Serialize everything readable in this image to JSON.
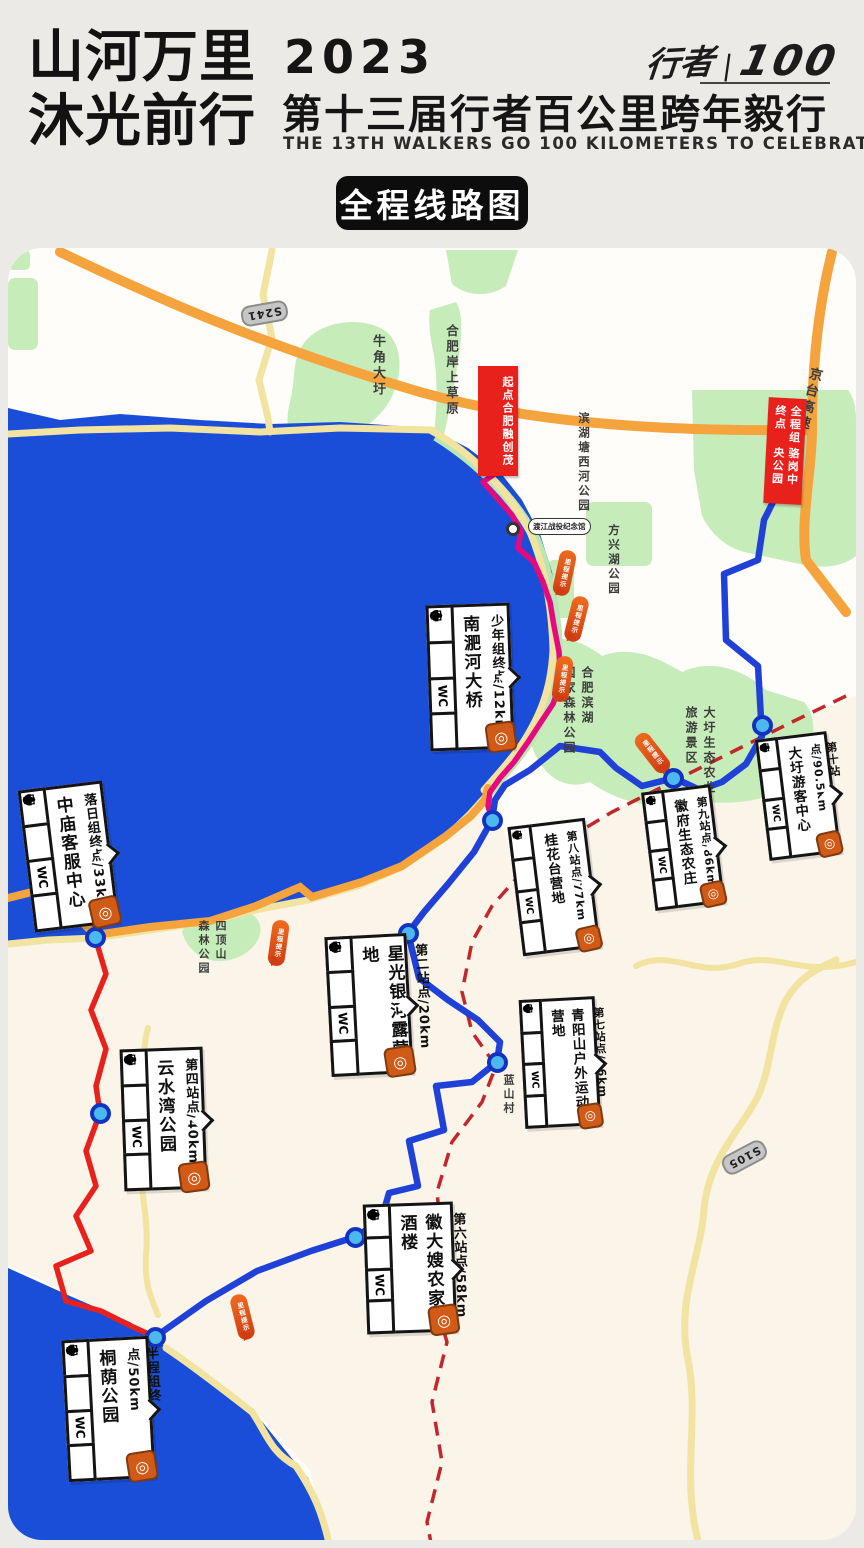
{
  "header": {
    "slogan_line1": "山河万里",
    "slogan_line2": "沐光前行",
    "year": "2023",
    "title": "第十三届行者百公里跨年毅行",
    "subtitle": "THE 13TH WALKERS GO 100 KILOMETERS TO CELEBRATE NEW YEAR",
    "logo_left": "行者",
    "logo_divider": "|",
    "logo_right": "100"
  },
  "badge": {
    "label": "全程线路图"
  },
  "map": {
    "start_box": {
      "line1": "起点",
      "line2": "合肥融创茂"
    },
    "finish_box": {
      "line1": "全程组终点",
      "line2": "骆岗中央公园"
    },
    "shields": [
      {
        "label": "S241"
      },
      {
        "label": "S105"
      }
    ],
    "labels": [
      {
        "text": "牛角大圩"
      },
      {
        "text": "合肥岸上草原"
      },
      {
        "text": "滨湖塘西河公园"
      },
      {
        "text": "方兴湖公园"
      },
      {
        "text": "京台高速"
      },
      {
        "line1": "合肥滨湖",
        "line2": "国家森林公园"
      },
      {
        "line1": "大圩生态农业",
        "line2": "旅游景区"
      },
      {
        "line1": "四顶山",
        "line2": "森林公园"
      },
      {
        "text": "蓝山村"
      }
    ],
    "poi": {
      "name": "渡江战役纪念馆"
    },
    "milestone_label": "里程提示",
    "wc": "WC",
    "target_glyph": "◎",
    "stations": [
      {
        "title": "少年组终点/12km",
        "name": "南淝河大桥"
      },
      {
        "title": "第二站点/20km",
        "name": "星光银河露营地"
      },
      {
        "title": "落日组终点/33km",
        "name": "中庙客服中心"
      },
      {
        "title": "第四站点/40km",
        "name": "云水湾公园"
      },
      {
        "title": "半程组终点/50km",
        "name": "桐荫公园"
      },
      {
        "title": "第六站点/58km",
        "name": "徽大嫂农家酒楼"
      },
      {
        "title": "第七站点/66km",
        "name": "青阳山户外运动营地"
      },
      {
        "title": "第八站点/77km",
        "name": "桂花台营地"
      },
      {
        "title": "第九站点/86km",
        "name": "徽府生态农庄"
      },
      {
        "title": "第十站点/90.5km",
        "name": "大圩游客中心"
      }
    ],
    "station_icons": [
      "water-drop",
      "medical-cross",
      "toilet-wc",
      "shuttle-bus",
      "checkpoint-target"
    ],
    "colors": {
      "lake": "#1b4ed8",
      "park": "#c6ecba",
      "road_minor": "#f2e3a1",
      "road_highway": "#f5a33d",
      "route_full": "#1f41d8",
      "route_start_leg": "#e5097f",
      "route_sunset_leg": "#e8211d",
      "boundary_dashed": "#c3272b",
      "milestone_marker": "#e2571c",
      "station_badge": "#d15a17"
    }
  }
}
